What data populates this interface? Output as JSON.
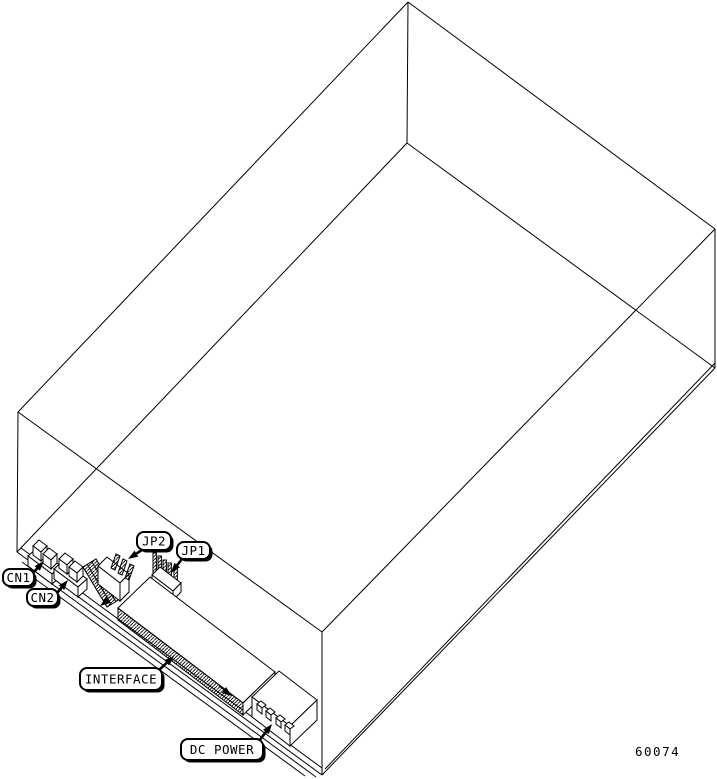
{
  "figure": {
    "figure_number": "60074",
    "background_color": "#ffffff",
    "line_color": "#000000",
    "callouts": [
      {
        "id": "cn1",
        "label": "CN1",
        "box": [
          3,
          569,
          31,
          17
        ],
        "tail": [
          33,
          573
        ],
        "tip": [
          44,
          561
        ]
      },
      {
        "id": "cn2",
        "label": "CN2",
        "box": [
          27,
          589,
          31,
          17
        ],
        "tail": [
          57,
          593
        ],
        "tip": [
          68,
          580
        ]
      },
      {
        "id": "jp2",
        "label": "JP2",
        "box": [
          137,
          532,
          34,
          18
        ],
        "tail": [
          142,
          550
        ],
        "tip": [
          128,
          559
        ]
      },
      {
        "id": "jp1",
        "label": "JP1",
        "box": [
          177,
          542,
          33,
          17
        ],
        "tail": [
          182,
          559
        ],
        "tip": [
          171,
          573
        ]
      },
      {
        "id": "interface",
        "label": "INTERFACE",
        "box": [
          80,
          668,
          82,
          22
        ],
        "tail": [
          158,
          671
        ],
        "tip": [
          174,
          656
        ]
      },
      {
        "id": "dc-power",
        "label": "DC POWER",
        "box": [
          181,
          739,
          82,
          21
        ],
        "tail": [
          259,
          741
        ],
        "tip": [
          272,
          724
        ]
      }
    ]
  }
}
